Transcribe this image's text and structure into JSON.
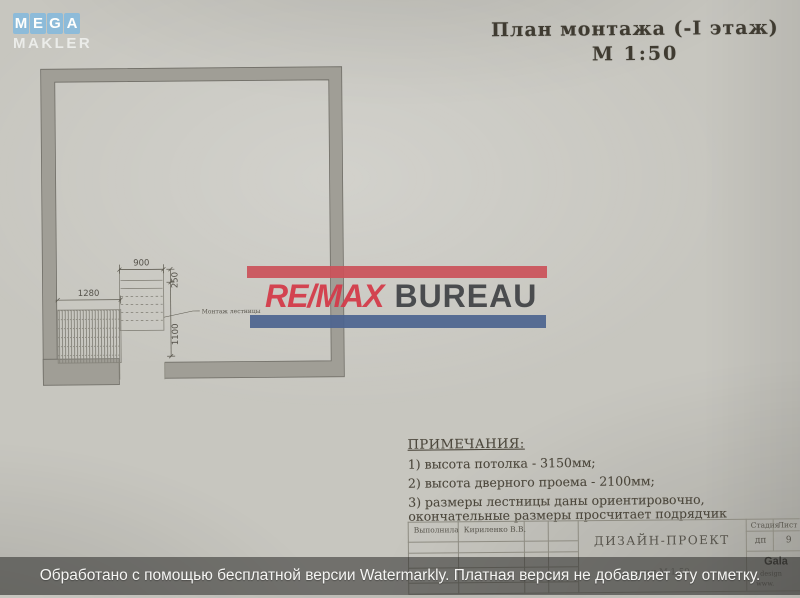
{
  "colors": {
    "paper": "#c7c6bf",
    "wall_fill": "#a09e96",
    "ink": "#55524a",
    "remax_red_bar": "#cb5159",
    "remax_red_text": "#d33b4a",
    "remax_blue_bar": "#4c648f",
    "mega_tile_blue": "#8abada",
    "bottom_bar": "#2a2a28"
  },
  "watermarks": {
    "mega_makler": {
      "tiles": [
        "M",
        "E",
        "G",
        "A"
      ],
      "subtitle": "MAKLER"
    },
    "remax": {
      "name": "RE/MAX",
      "suffix": "BUREAU"
    },
    "bottom_bar": {
      "text": "Обработано с помощью бесплатной версии Watermarkly. Платная версия не добавляет эту отметку."
    }
  },
  "drawing": {
    "title_line1": "План монтажа (-I этаж)",
    "title_line2": "М 1:50",
    "plan": {
      "dim_900": "900",
      "dim_1280": "1280",
      "dim_250": "250",
      "dim_1100": "1100",
      "stairs_label": "Монтаж лестницы"
    },
    "notes": {
      "heading": "ПРИМЕЧАНИЯ:",
      "items": [
        "1) высота потолка - 3150мм;",
        "2) высота дверного проема - 2100мм;",
        "3) размеры лестницы даны ориентировочно, окончательные размеры просчитает подрядчик"
      ]
    },
    "titleblock": {
      "author_label": "Выполнила",
      "author_value": "Кириленко В.В.",
      "project_title": "ДИЗАЙН-ПРОЕКТ",
      "sheet_caption": "план М 1:50",
      "stage_label": "Стадия",
      "list_label": "Лист",
      "stage_value": "дп",
      "list_value": "9",
      "firm_name": "Gala",
      "firm_line2": "design",
      "firm_line3": "www."
    }
  }
}
